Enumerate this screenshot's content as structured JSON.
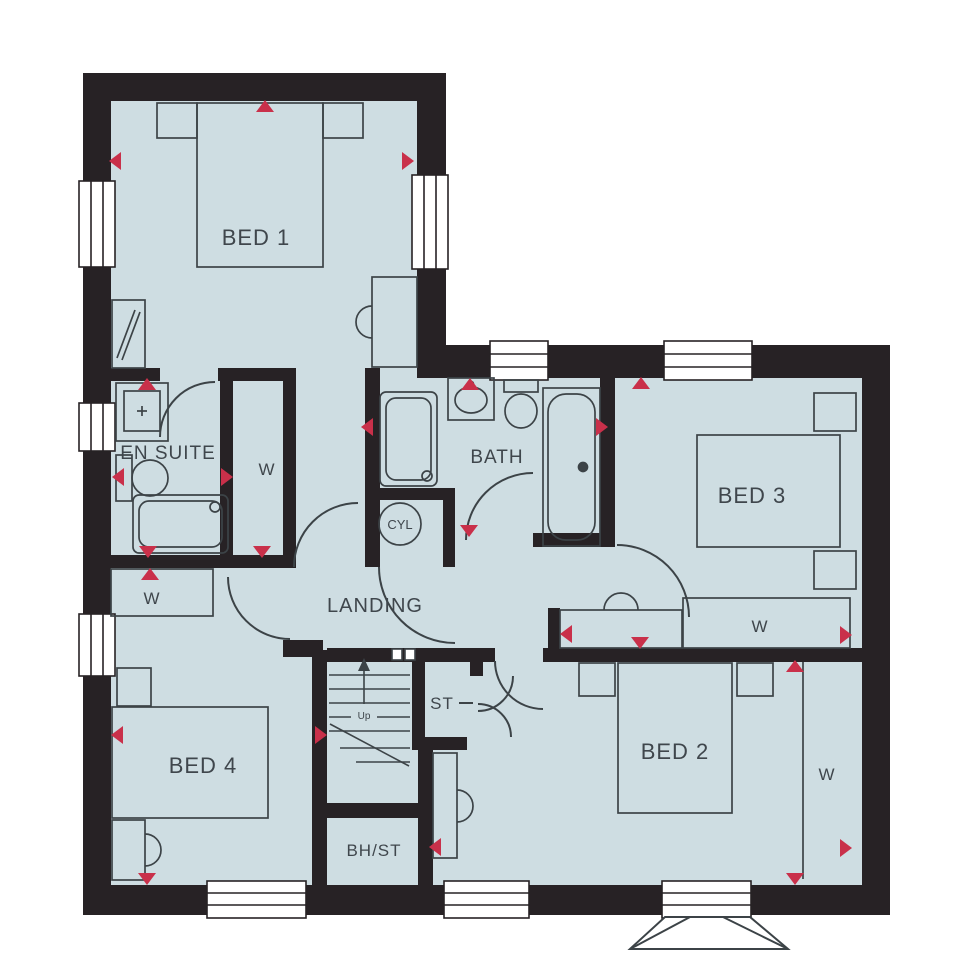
{
  "floorplan": {
    "description": "First floor house plan",
    "rooms": [
      {
        "id": "bed1",
        "label": "BED 1"
      },
      {
        "id": "en-suite",
        "label": "EN SUITE"
      },
      {
        "id": "bath",
        "label": "BATH"
      },
      {
        "id": "bed3",
        "label": "BED 3"
      },
      {
        "id": "landing",
        "label": "LANDING"
      },
      {
        "id": "cylinder-cupboard",
        "label": "CYL"
      },
      {
        "id": "bed4",
        "label": "BED 4"
      },
      {
        "id": "store",
        "label": "ST"
      },
      {
        "id": "bulkhead-store",
        "label": "BH/ST"
      },
      {
        "id": "bed2",
        "label": "BED 2"
      }
    ],
    "wardrobes": [
      {
        "id": "wardrobe-bed1",
        "label": "W"
      },
      {
        "id": "wardrobe-bed4",
        "label": "W"
      },
      {
        "id": "wardrobe-bed3",
        "label": "W"
      },
      {
        "id": "wardrobe-bed2",
        "label": "W"
      }
    ],
    "stairs": {
      "label": "Up"
    },
    "icons": {
      "marker": "red-alarm-triangle-marker"
    },
    "colors": {
      "wall": "#272225",
      "floor": "#cedde2",
      "marker": "#c9304a",
      "line": "#3c4347",
      "text": "#3f464c",
      "background": "#ffffff"
    }
  }
}
